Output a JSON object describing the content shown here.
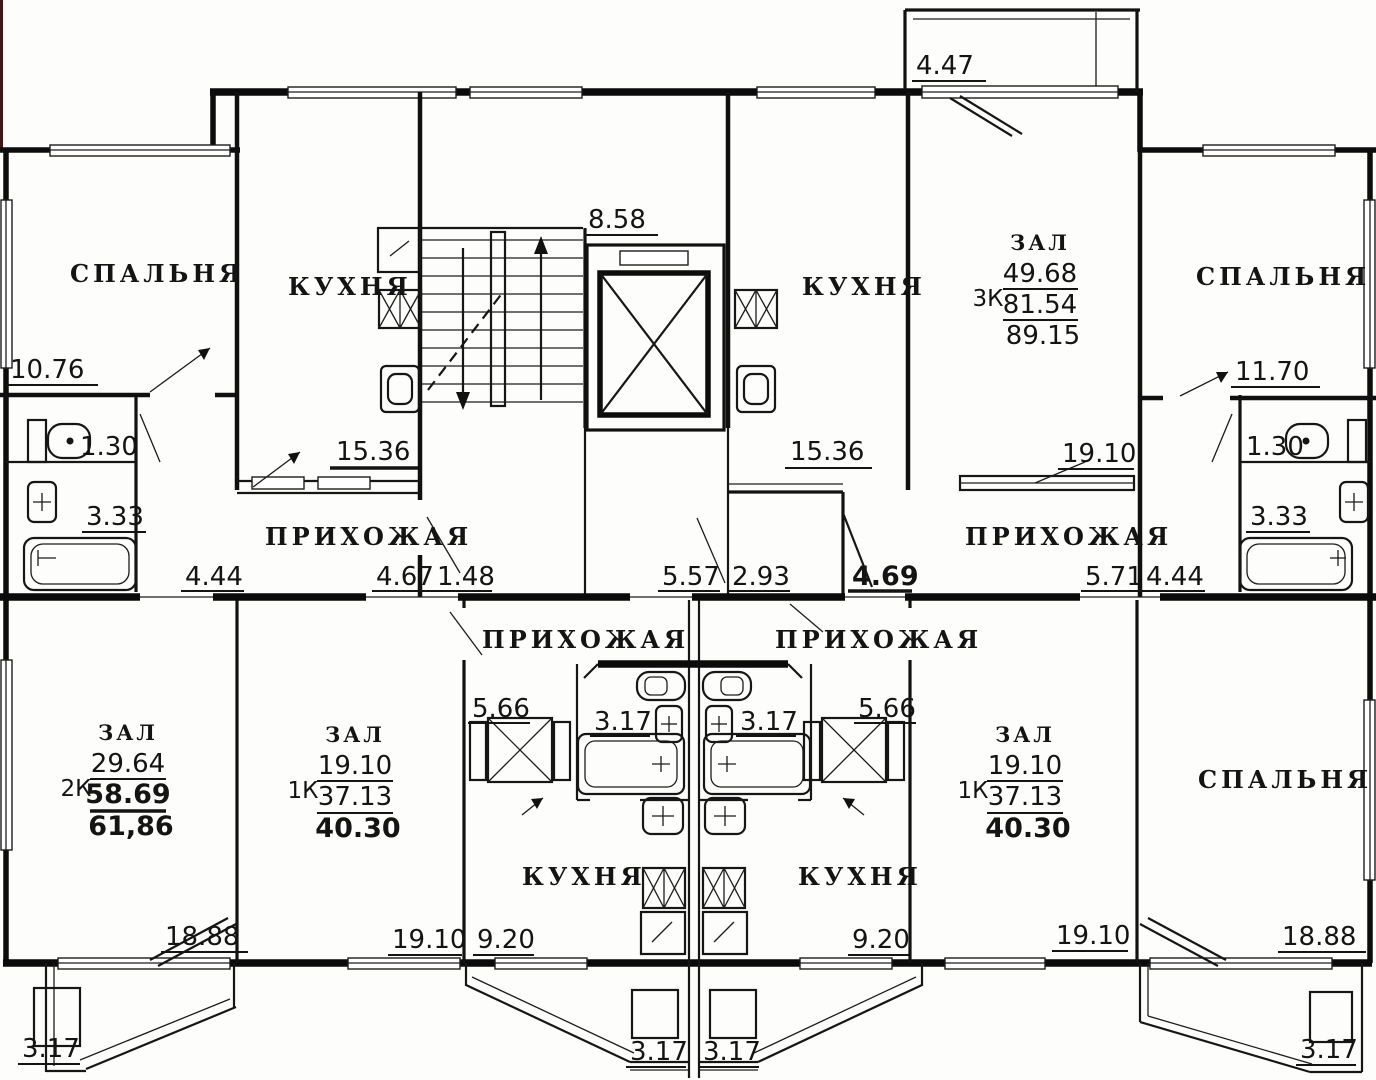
{
  "plan": {
    "room_labels": {
      "bedroom_tl": "СПАЛЬНЯ",
      "kitchen_tl": "КУХНЯ",
      "kitchen_tr": "КУХНЯ",
      "bedroom_tr": "СПАЛЬНЯ",
      "hallway_tl": "ПРИХОЖАЯ",
      "hallway_tr": "ПРИХОЖАЯ",
      "hallway_bl": "ПРИХОЖАЯ",
      "hallway_br": "ПРИХОЖАЯ",
      "kitchen_bl": "КУХНЯ",
      "kitchen_br": "КУХНЯ",
      "bedroom_br": "СПАЛЬНЯ"
    },
    "apartments": {
      "apt_3k": {
        "room_name": "ЗАЛ",
        "type": "3К",
        "room": "49.68",
        "living": "81.54",
        "total": "89.15"
      },
      "apt_2k": {
        "room_name": "ЗАЛ",
        "type": "2К",
        "room": "29.64",
        "living": "58.69",
        "total": "61,86"
      },
      "apt_1k_left": {
        "room_name": "ЗАЛ",
        "type": "1К",
        "room": "19.10",
        "living": "37.13",
        "total": "40.30"
      },
      "apt_1k_right": {
        "room_name": "ЗАЛ",
        "type": "1К",
        "room": "19.10",
        "living": "37.13",
        "total": "40.30"
      }
    },
    "dimensions": {
      "stair_bay": "8.58",
      "balcony_top": "4.47",
      "bedroom_tl": "10.76",
      "kitchen_tl": "15.36",
      "kitchen_tr": "15.36",
      "wc_tl": "1.30",
      "bath_tl": "3.33",
      "hall_tl_a": "4.44",
      "hall_tl_b": "4.67",
      "hall_tl_c": "1.48",
      "hall_c_a": "5.57",
      "hall_c_b": "2.93",
      "storage_tr": "4.69",
      "zal_tr_width": "19.10",
      "hall_tr_a": "5.71",
      "hall_tr_b": "4.44",
      "wc_tr": "1.30",
      "bath_tr": "3.33",
      "bedroom_tr": "11.70",
      "closet_bl": "5.66",
      "bath_bl": "3.17",
      "bath_br": "3.17",
      "closet_br": "5.66",
      "zal_bl_width": "18.88",
      "zal_1kl_width": "19.10",
      "kitchen_bl_width": "9.20",
      "kitchen_br_width": "9.20",
      "zal_1kr_width": "19.10",
      "bedroom_br_width": "18.88",
      "balcony_bl": "3.17",
      "balcony_bcl": "3.17",
      "balcony_bcr": "3.17",
      "balcony_br": "3.17"
    }
  }
}
